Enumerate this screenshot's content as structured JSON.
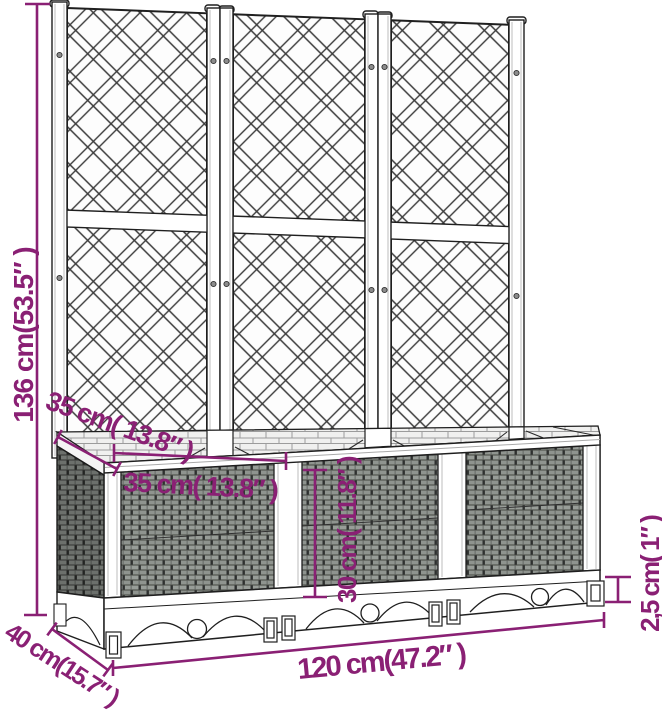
{
  "diagram": {
    "subject": "garden planter with trellis",
    "background_color": "#ffffff",
    "line_color": "#1f1f1f",
    "accent_color": "#8a2074",
    "trellis_panel_count": 3,
    "planter_module_count": 3
  },
  "dimensions": {
    "total_height": "136 cm(53.5″ )",
    "inner_depth": "35 cm( 13.8″ )",
    "inner_width": "35 cm( 13.8″ )",
    "inner_height": "30 cm( 11.8″ )",
    "outer_depth": "40 cm(15.7″ )",
    "outer_width": "120 cm(47.2″ )",
    "foot_height": "2,5 cm( 1″ )"
  }
}
